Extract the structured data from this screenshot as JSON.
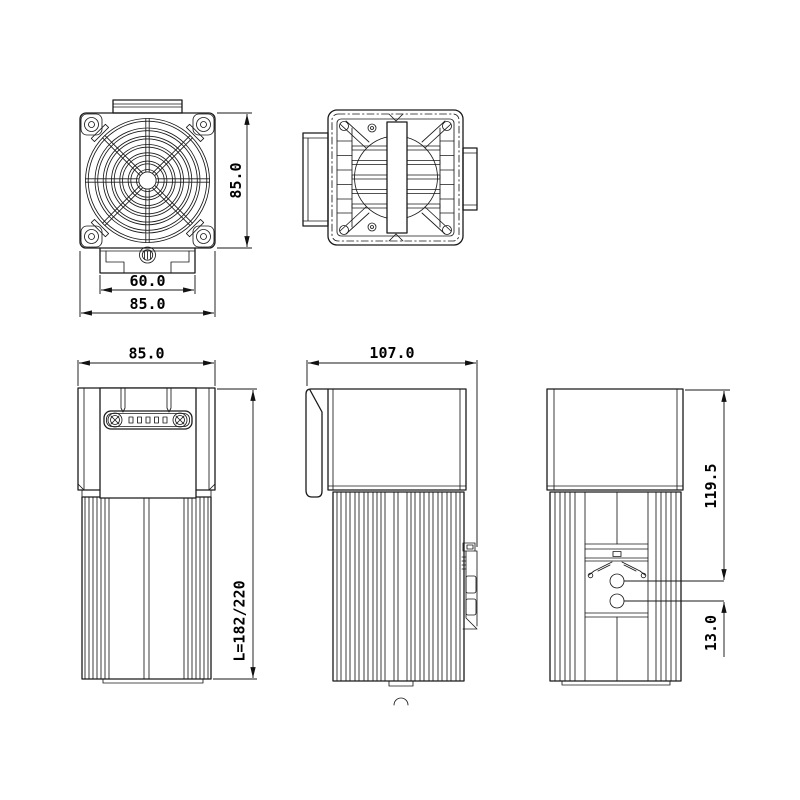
{
  "sheet": {
    "background": "#ffffff",
    "line_color": "#1a1a1a"
  },
  "dimensions": {
    "fan_view_height": "85.0",
    "fan_view_clip_width": "60.0",
    "fan_view_width": "85.0",
    "front_view_width": "85.0",
    "side_view_depth": "107.0",
    "overall_length": "L=182/220",
    "clip_to_top_offset": "119.5",
    "hole_spacing": "13.0"
  }
}
